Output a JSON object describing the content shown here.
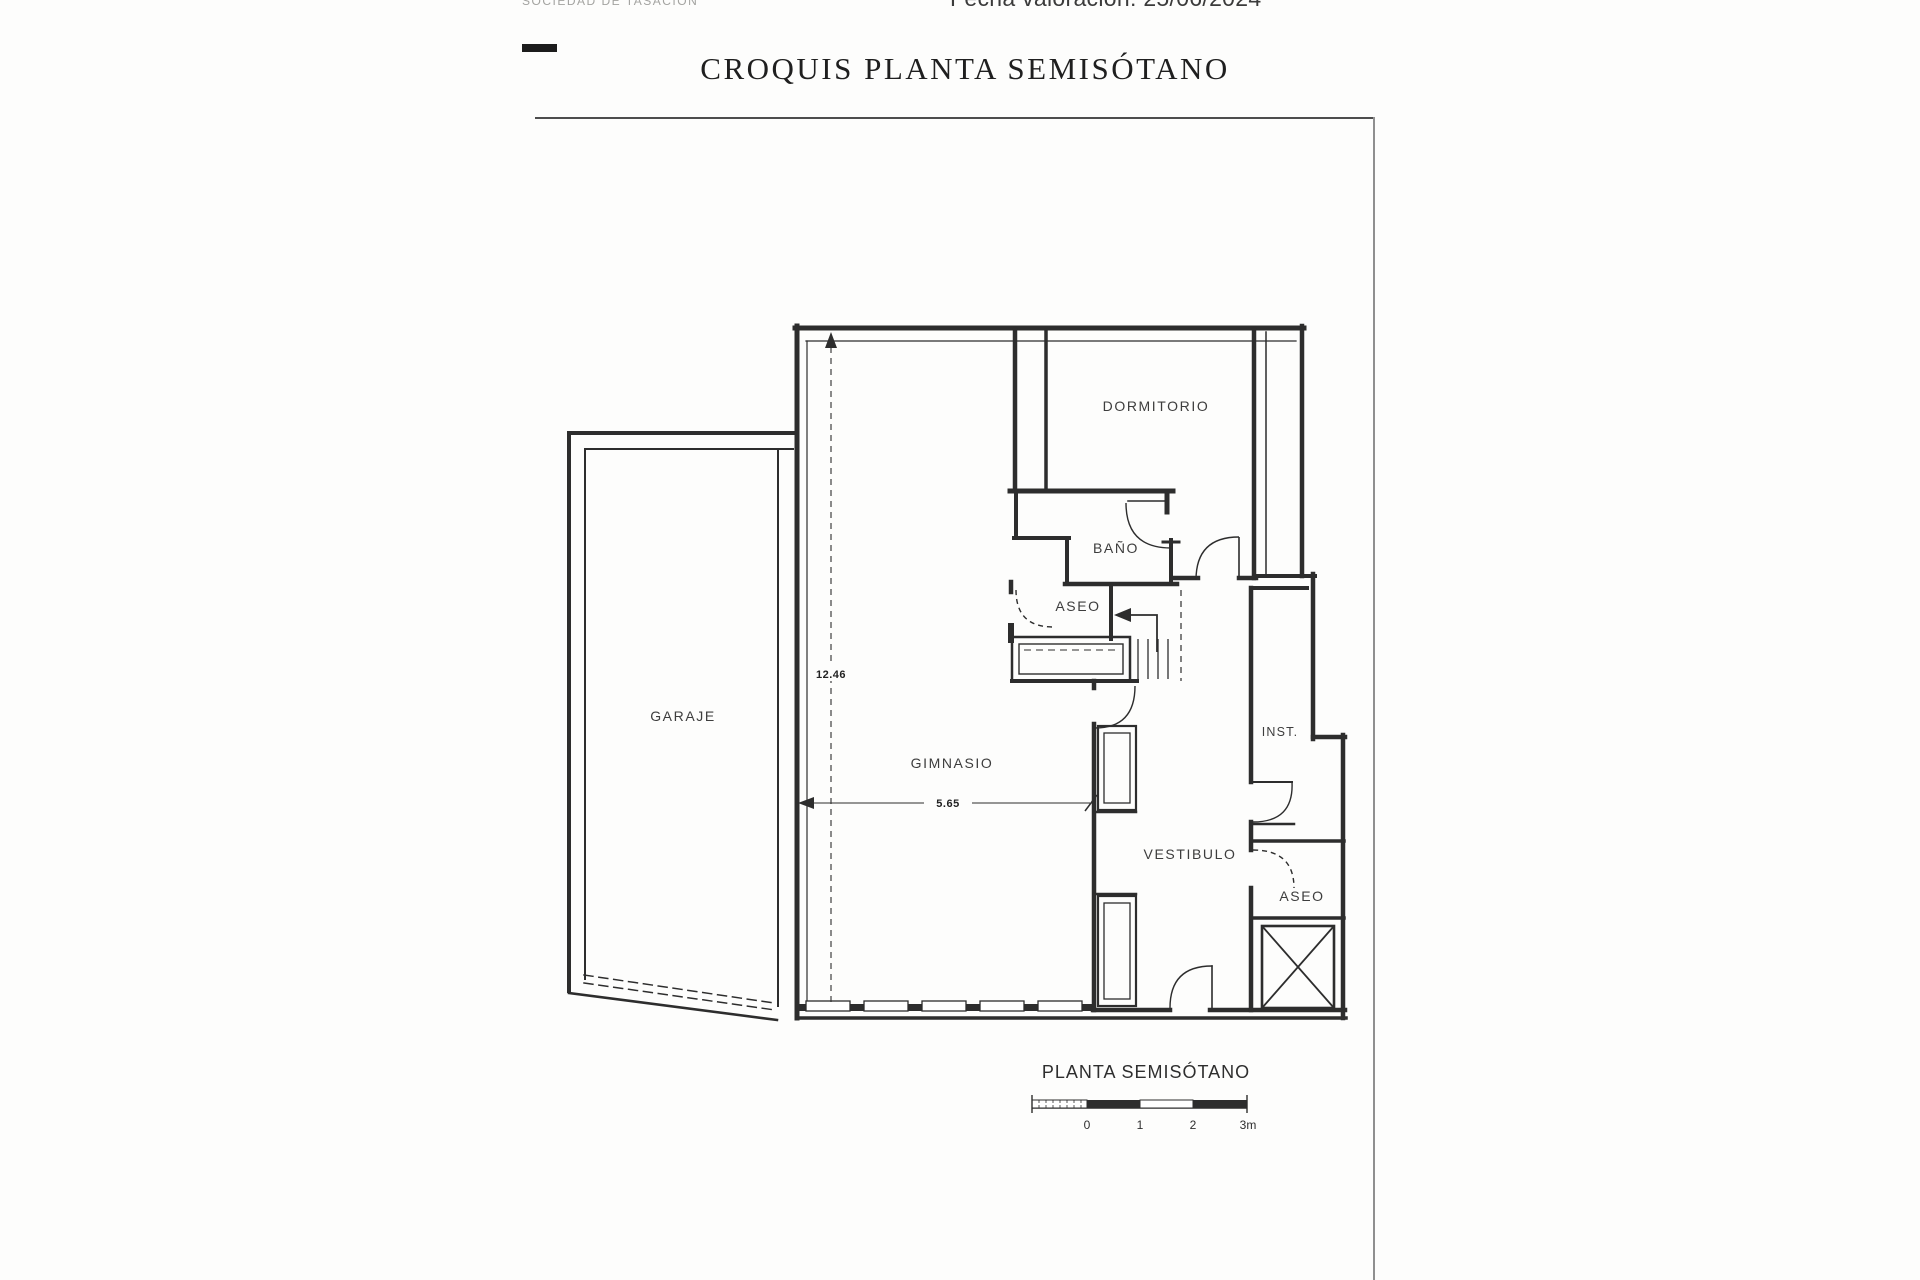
{
  "header": {
    "logo_text": "SOCIEDAD DE TASACIÓN",
    "valuation_date": "Fecha valoración: 25/06/2024",
    "title": "CROQUIS PLANTA SEMISÓTANO"
  },
  "plan": {
    "rooms": {
      "garaje": "GARAJE",
      "gimnasio": "GIMNASIO",
      "dormitorio": "DORMITORIO",
      "bano": "BAÑO",
      "aseo": "ASEO",
      "vestibulo": "VESTIBULO",
      "inst": "INST.",
      "aseo2": "ASEO"
    },
    "dimensions": {
      "vertical": "12.46",
      "horizontal": "5.65"
    },
    "caption": "PLANTA SEMISÓTANO",
    "scale_bar": {
      "labels": [
        "0",
        "1",
        "2",
        "3m"
      ]
    }
  },
  "colors": {
    "ink": "#2d2d2d",
    "muted_gray": "#a3a3a0"
  }
}
